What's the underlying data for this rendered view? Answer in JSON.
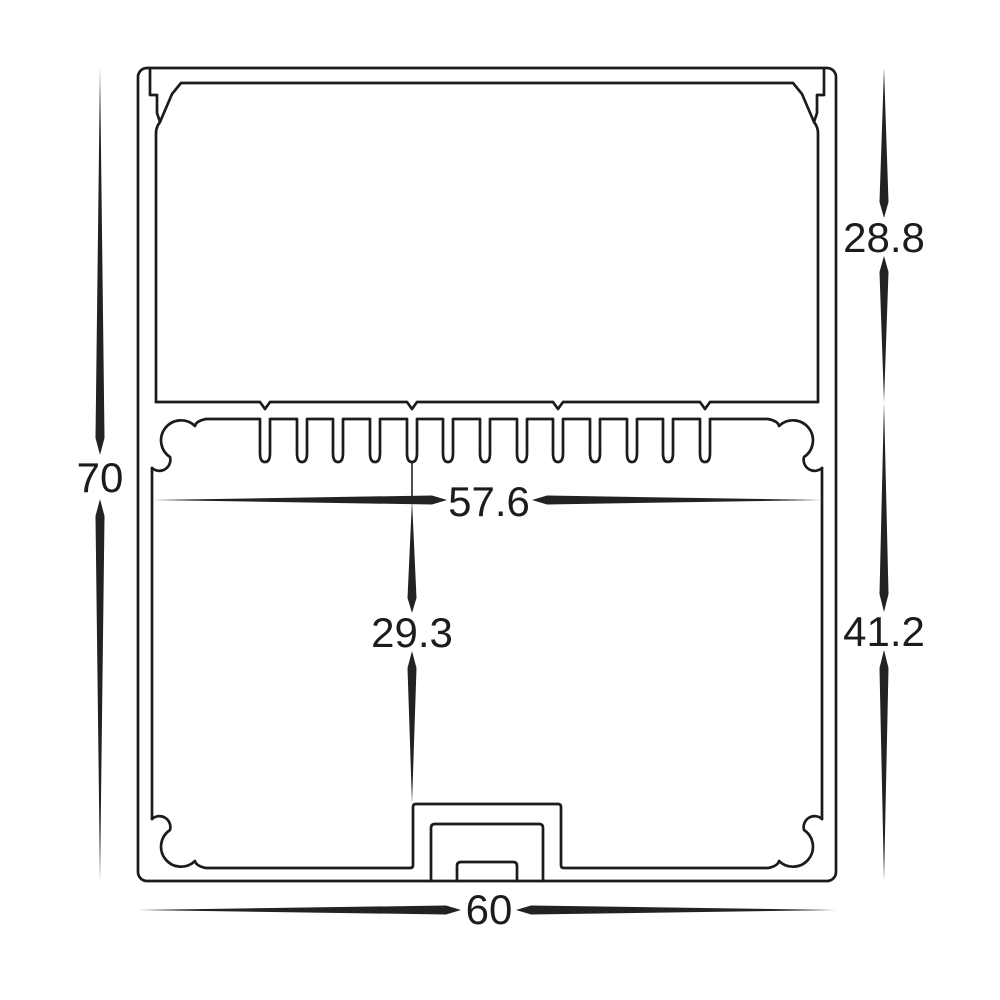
{
  "drawing": {
    "kind": "extrusion-profile-cross-section",
    "colors": {
      "line": "#1b1b1b",
      "text": "#1c1c1c",
      "background": "#ffffff"
    },
    "dimensions": {
      "overall_height": {
        "label": "70",
        "value": 70,
        "orientation": "vertical",
        "side": "left"
      },
      "upper_section_height": {
        "label": "28.8",
        "value": 28.8,
        "orientation": "vertical",
        "side": "right-top"
      },
      "lower_section_height": {
        "label": "41.2",
        "value": 41.2,
        "orientation": "vertical",
        "side": "right-bottom"
      },
      "inner_width": {
        "label": "57.6",
        "value": 57.6,
        "orientation": "horizontal",
        "side": "middle"
      },
      "inner_cavity_height": {
        "label": "29.3",
        "value": 29.3,
        "orientation": "vertical",
        "side": "middle"
      },
      "overall_width": {
        "label": "60",
        "value": 60,
        "orientation": "horizontal",
        "side": "bottom"
      }
    }
  }
}
